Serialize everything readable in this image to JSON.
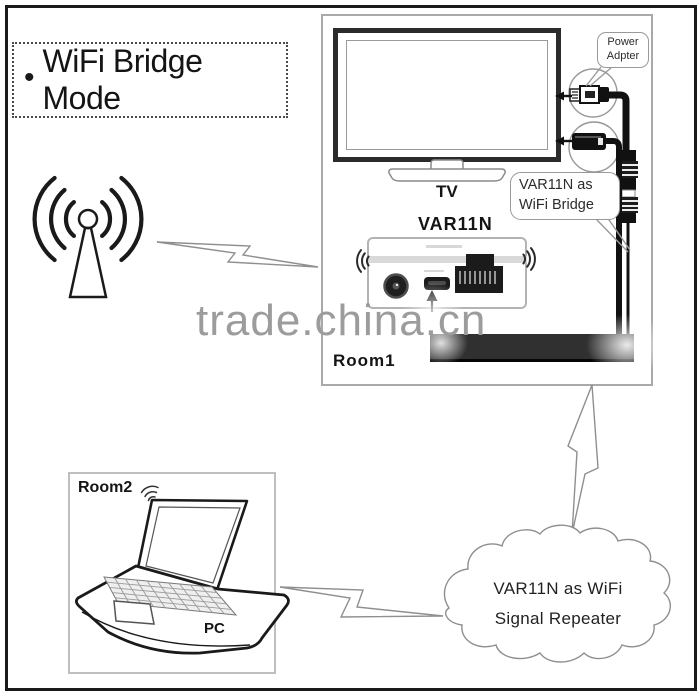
{
  "title": {
    "bullet": "•",
    "text": "WiFi Bridge Mode"
  },
  "watermark": {
    "text": "trade.china.cn"
  },
  "room1": {
    "label": "Room1",
    "tv_label": "TV",
    "device_label": "VAR11N"
  },
  "room2": {
    "label": "Room2",
    "pc_label": "PC"
  },
  "callouts": {
    "power": {
      "lines": [
        "Power",
        "Adpter"
      ]
    },
    "bridge": {
      "lines": [
        "VAR11N as",
        "WiFi Bridge"
      ]
    }
  },
  "cloud": {
    "lines": [
      "VAR11N as WiFi",
      "Signal Repeater"
    ]
  },
  "colors": {
    "ink": "#1a1a1a",
    "box1": "#a9a9a9",
    "box2": "#bfbfbf",
    "bezel": "#2b2b2b",
    "seam": "#d9d9d9",
    "band": "#303030",
    "wm": "#9c9c9c",
    "sketch": "#8f8f8f",
    "callout": "#999999"
  }
}
